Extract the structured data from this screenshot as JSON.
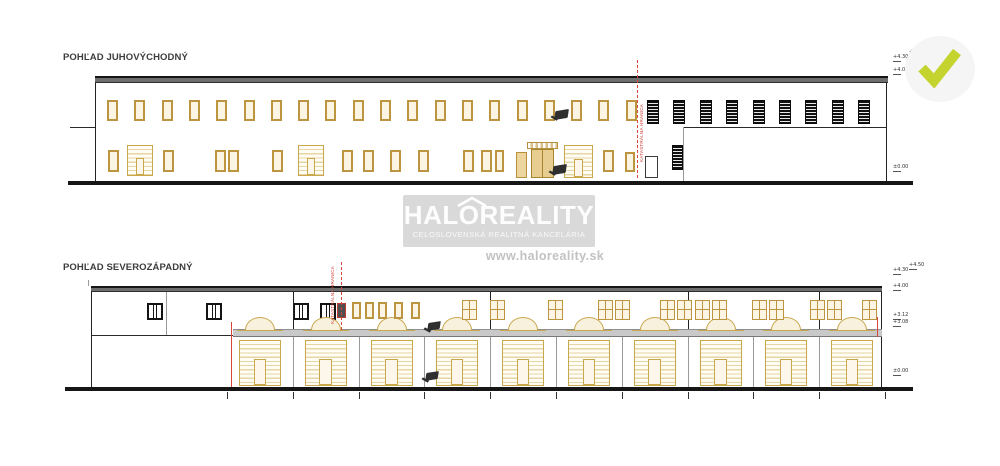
{
  "watermark": {
    "brand": "HALOREALITY",
    "tagline": "CELOSLOVENSKÁ REALITNÁ KANCELÁRIA",
    "url": "www.haloreality.sk",
    "box_color": "#d9d9d9",
    "text_color": "#ffffff",
    "url_color": "#c2c2c2"
  },
  "approval": {
    "check_color": "#c4d32e",
    "circle_color": "#f5f5f5"
  },
  "palette": {
    "tan_border": "#bd9440",
    "tan_fill": "#fcf5e4",
    "roof_gray": "#6e6e6e",
    "ground_black": "#161616",
    "boundary_red": "#d8453a",
    "canopy_gray": "#c9c9c9"
  },
  "drawings": [
    {
      "name": "elevation-southeast",
      "title": "POHĽAD JUHOVÝCHODNÝ",
      "boundary_label": "KATASTRÁLNA HRANICA",
      "levels": [
        "+4.30",
        "+4.50",
        "+4.05",
        "±0.00"
      ],
      "elements": [
        {
          "t": "ground",
          "x": 68,
          "y": 181,
          "w": 845,
          "h": 4
        },
        {
          "t": "roof",
          "x": 95,
          "y": 76,
          "w": 793,
          "h": 7
        },
        {
          "t": "vline2",
          "x": 95,
          "y": 83,
          "h": 98
        },
        {
          "t": "vline2",
          "x": 886,
          "y": 83,
          "h": 98
        },
        {
          "t": "hline",
          "x": 70,
          "y": 127,
          "w": 25
        },
        {
          "t": "window-tan",
          "x": 107,
          "y": 100,
          "w": 11,
          "h": 21,
          "n": 20,
          "dx": 27.3
        },
        {
          "t": "window-tan",
          "x": 108,
          "y": 150,
          "w": 11,
          "h": 22
        },
        {
          "t": "window-tan",
          "x": 163,
          "y": 150,
          "w": 11,
          "h": 22
        },
        {
          "t": "window-tan",
          "x": 215,
          "y": 150,
          "w": 11,
          "h": 22,
          "n": 2,
          "dx": 13
        },
        {
          "t": "window-tan",
          "x": 272,
          "y": 150,
          "w": 11,
          "h": 22
        },
        {
          "t": "window-tan",
          "x": 342,
          "y": 150,
          "w": 11,
          "h": 22
        },
        {
          "t": "window-tan",
          "x": 363,
          "y": 150,
          "w": 11,
          "h": 22
        },
        {
          "t": "window-tan",
          "x": 390,
          "y": 150,
          "w": 11,
          "h": 22
        },
        {
          "t": "window-tan",
          "x": 418,
          "y": 150,
          "w": 11,
          "h": 22
        },
        {
          "t": "window-tan",
          "x": 463,
          "y": 150,
          "w": 11,
          "h": 22,
          "n": 2,
          "dx": 18
        },
        {
          "t": "window-tan",
          "x": 495,
          "y": 150,
          "w": 9,
          "h": 22
        },
        {
          "t": "window-tan",
          "x": 603,
          "y": 150,
          "w": 11,
          "h": 22
        },
        {
          "t": "window-tan",
          "x": 625,
          "y": 152,
          "w": 10,
          "h": 20
        },
        {
          "t": "garage",
          "x": 127,
          "y": 145,
          "w": 26,
          "h": 31
        },
        {
          "t": "garage",
          "x": 298,
          "y": 145,
          "w": 26,
          "h": 31
        },
        {
          "t": "door-tan",
          "x": 516,
          "y": 152,
          "w": 11,
          "h": 26
        },
        {
          "t": "canopy-sm",
          "x": 527,
          "y": 142,
          "w": 31,
          "h": 7
        },
        {
          "t": "door-tan2",
          "x": 531,
          "y": 149,
          "w": 23,
          "h": 29
        },
        {
          "t": "garage",
          "x": 564,
          "y": 145,
          "w": 29,
          "h": 33
        },
        {
          "t": "window-dark",
          "x": 647,
          "y": 100,
          "w": 12,
          "h": 24,
          "n": 9,
          "dx": 26.4
        },
        {
          "t": "hline",
          "x": 683,
          "y": 127,
          "w": 203
        },
        {
          "t": "vline",
          "x": 683,
          "y": 127,
          "h": 54
        },
        {
          "t": "door-w",
          "x": 645,
          "y": 156,
          "w": 13,
          "h": 22
        },
        {
          "t": "window-dark",
          "x": 672,
          "y": 145,
          "w": 11,
          "h": 25
        },
        {
          "t": "redv",
          "x": 637,
          "y": 60,
          "h": 118,
          "name": "boundary-line"
        },
        {
          "t": "vtext",
          "x": 640,
          "y": 92,
          "h": 70,
          "text": "KATASTRÁLNA HRANICA",
          "name": "boundary-label"
        },
        {
          "t": "lamp",
          "x": 555,
          "y": 110,
          "w": 13,
          "h": 9,
          "name": "wall-lamp-symbol"
        },
        {
          "t": "lamp",
          "x": 553,
          "y": 165,
          "w": 13,
          "h": 9,
          "name": "wall-lamp-symbol"
        },
        {
          "t": "level",
          "x": 893,
          "y": 55,
          "text": "+4.30",
          "name": "level-label"
        },
        {
          "t": "level",
          "x": 909,
          "y": 50,
          "text": "+4.50",
          "name": "level-label"
        },
        {
          "t": "level",
          "x": 893,
          "y": 68,
          "text": "+4.05",
          "name": "level-label"
        },
        {
          "t": "level",
          "x": 893,
          "y": 165,
          "text": "±0.00",
          "name": "level-label"
        }
      ]
    },
    {
      "name": "elevation-northwest",
      "title": "POHĽAD SEVEROZÁPADNÝ",
      "boundary_label": "KATASTRÁLNA HRANICA",
      "levels": [
        "+4.30",
        "+4.50",
        "+4.00",
        "+3.12",
        "+3.08",
        "±0.00"
      ],
      "elements": [
        {
          "t": "ground",
          "x": 65,
          "y": 387,
          "w": 848,
          "h": 4
        },
        {
          "t": "roof",
          "x": 91,
          "y": 286,
          "w": 791,
          "h": 6
        },
        {
          "t": "vline2",
          "x": 91,
          "y": 292,
          "h": 95
        },
        {
          "t": "vline",
          "x": 88,
          "y": 280,
          "h": 6
        },
        {
          "t": "vline2",
          "x": 881,
          "y": 292,
          "h": 95
        },
        {
          "t": "vline",
          "x": 166,
          "y": 292,
          "h": 43
        },
        {
          "t": "hline",
          "x": 91,
          "y": 335,
          "w": 142
        },
        {
          "t": "window-mullion",
          "x": 147,
          "y": 303,
          "w": 16,
          "h": 17
        },
        {
          "t": "window-mullion",
          "x": 206,
          "y": 303,
          "w": 16,
          "h": 17
        },
        {
          "t": "window-mullion",
          "x": 293,
          "y": 303,
          "w": 16,
          "h": 17
        },
        {
          "t": "window-mullion",
          "x": 320,
          "y": 303,
          "w": 16,
          "h": 17
        },
        {
          "t": "window-red",
          "x": 337,
          "y": 303,
          "w": 9,
          "h": 15
        },
        {
          "t": "canopy",
          "x": 233,
          "y": 329,
          "w": 649,
          "h": 8
        },
        {
          "t": "arch",
          "x": 245,
          "y": 317,
          "w": 30,
          "h": 13,
          "n": 10,
          "dx": 65.8
        },
        {
          "t": "garage",
          "x": 239,
          "y": 340,
          "w": 42,
          "h": 46,
          "n": 10,
          "dx": 65.8
        },
        {
          "t": "vline",
          "x": 292.8,
          "y": 337,
          "h": 50,
          "n": 9,
          "dx": 65.8
        },
        {
          "t": "vline2",
          "x": 292.8,
          "y": 292,
          "h": 37
        },
        {
          "t": "vline2",
          "x": 490.2,
          "y": 292,
          "h": 37
        },
        {
          "t": "vline2",
          "x": 687.6,
          "y": 292,
          "h": 37
        },
        {
          "t": "vline2",
          "x": 819.2,
          "y": 292,
          "h": 37
        },
        {
          "t": "window-tan",
          "x": 352,
          "y": 302,
          "w": 9,
          "h": 17,
          "n": 2,
          "dx": 13
        },
        {
          "t": "window-tan",
          "x": 378,
          "y": 302,
          "w": 9,
          "h": 17
        },
        {
          "t": "window-tan",
          "x": 394,
          "y": 302,
          "w": 9,
          "h": 17,
          "n": 2,
          "dx": 17
        },
        {
          "t": "window-cross",
          "x": 462,
          "y": 300,
          "w": 15,
          "h": 20,
          "n": 2,
          "dx": 28
        },
        {
          "t": "window-cross",
          "x": 548,
          "y": 300,
          "w": 15,
          "h": 20
        },
        {
          "t": "window-cross",
          "x": 598,
          "y": 300,
          "w": 15,
          "h": 20,
          "n": 2,
          "dx": 17
        },
        {
          "t": "window-cross",
          "x": 660,
          "y": 300,
          "w": 15,
          "h": 20,
          "n": 2,
          "dx": 17
        },
        {
          "t": "window-cross",
          "x": 695,
          "y": 300,
          "w": 15,
          "h": 20,
          "n": 2,
          "dx": 17
        },
        {
          "t": "window-cross",
          "x": 752,
          "y": 300,
          "w": 15,
          "h": 20,
          "n": 2,
          "dx": 17
        },
        {
          "t": "window-cross",
          "x": 810,
          "y": 300,
          "w": 15,
          "h": 20,
          "n": 2,
          "dx": 17
        },
        {
          "t": "window-cross",
          "x": 862,
          "y": 300,
          "w": 15,
          "h": 20
        },
        {
          "t": "redv",
          "x": 341,
          "y": 262,
          "h": 68,
          "name": "boundary-line"
        },
        {
          "t": "vtext",
          "x": 331,
          "y": 264,
          "h": 60,
          "text": "KATASTRÁLNA HRANICA",
          "name": "boundary-label"
        },
        {
          "t": "redv2",
          "x": 231,
          "y": 322,
          "h": 65,
          "name": "boundary-edge-line"
        },
        {
          "t": "redv2",
          "x": 877,
          "y": 317,
          "h": 20,
          "name": "boundary-edge-line"
        },
        {
          "t": "tick",
          "x": 227,
          "y": 392,
          "h": 7,
          "n": 11,
          "dx": 65.8
        },
        {
          "t": "lamp",
          "x": 428,
          "y": 322,
          "w": 12,
          "h": 8,
          "name": "wall-lamp-symbol"
        },
        {
          "t": "lamp",
          "x": 426,
          "y": 372,
          "w": 12,
          "h": 8,
          "name": "wall-lamp-symbol"
        },
        {
          "t": "level",
          "x": 893,
          "y": 268,
          "text": "+4.30",
          "name": "level-label"
        },
        {
          "t": "level",
          "x": 909,
          "y": 263,
          "text": "+4.50",
          "name": "level-label"
        },
        {
          "t": "level",
          "x": 893,
          "y": 284,
          "text": "+4.00",
          "name": "level-label"
        },
        {
          "t": "level",
          "x": 893,
          "y": 313,
          "text": "+3.12",
          "name": "level-label"
        },
        {
          "t": "level",
          "x": 893,
          "y": 320,
          "text": "+3.08",
          "name": "level-label"
        },
        {
          "t": "level",
          "x": 893,
          "y": 369,
          "text": "±0.00",
          "name": "level-label"
        }
      ]
    }
  ]
}
